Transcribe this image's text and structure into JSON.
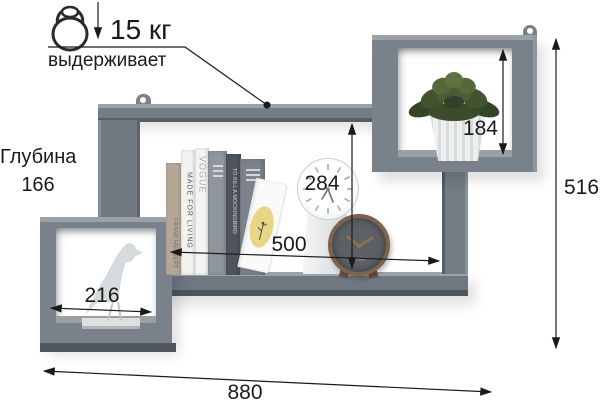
{
  "diagram": {
    "type": "product-dimension-diagram",
    "subject": "wall-mounted zigzag shelf with two cube compartments"
  },
  "load": {
    "value": "15 кг",
    "caption": "выдерживает"
  },
  "depth": {
    "label": "Глубина",
    "value": "166"
  },
  "dims": {
    "right_box_height": "184",
    "middle_height": "284",
    "shelf_width": "500",
    "left_box_width": "216",
    "total_width": "880",
    "total_height": "516"
  },
  "books": {
    "book1_spine": "FRANK HERBERT",
    "book2_spine": "MADE FOR LIVING",
    "book3_spine": "VOGUE",
    "book5_spine": "TO KILL A MOCKINGBIRD"
  },
  "colors": {
    "shelf": "#747c84",
    "shelf_light": "#9aa1a7",
    "shelf_dark": "#535b62",
    "dimension_line": "#1a1a1a",
    "booklet_accent": "#e7d688",
    "plant_green": "#465a31",
    "clock_wood": "#7e6249"
  }
}
